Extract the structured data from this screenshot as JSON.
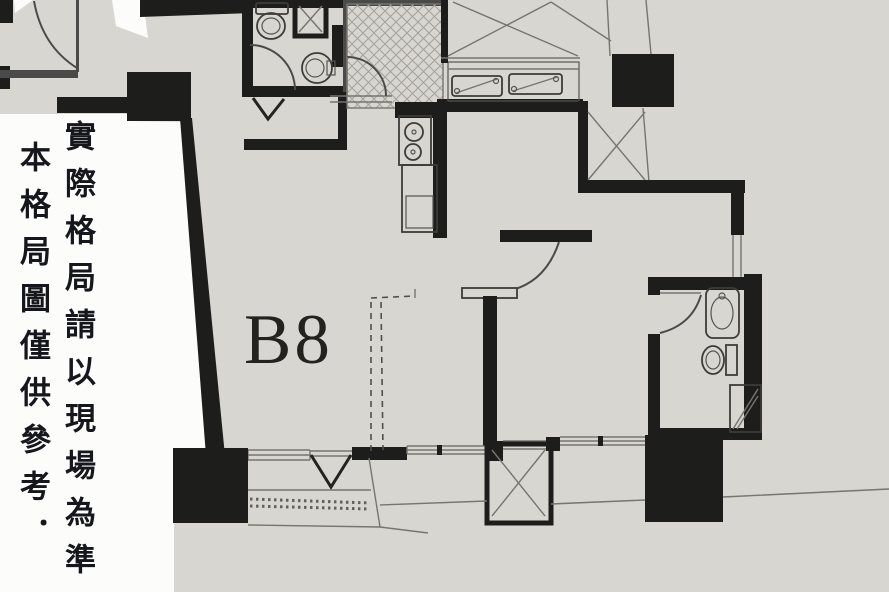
{
  "unit": {
    "label": "B8"
  },
  "disclaimer": {
    "line1": "本格局圖僅供參考．",
    "line2": "實際格局請以現場為準"
  },
  "colors": {
    "paper": "#d8d6d1",
    "margin": "#fcfcfb",
    "wall": "#1d1d1b",
    "line": "#4a4a48",
    "thin": "#77756f",
    "hatch": "#a5a199",
    "text": "#16161d"
  }
}
